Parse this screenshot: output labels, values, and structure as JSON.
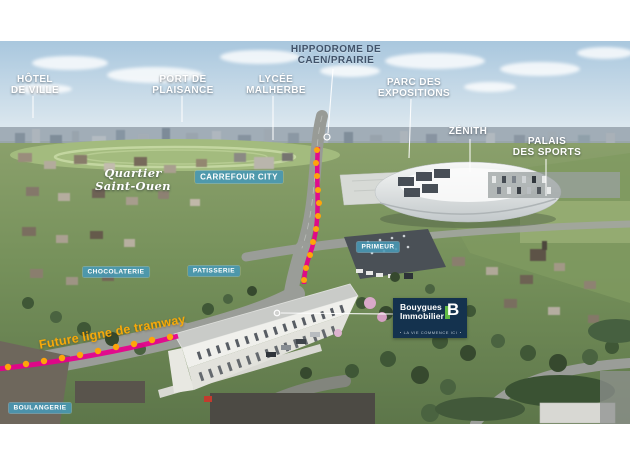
{
  "labels": {
    "hotel_de_ville": {
      "line1": "HÔTEL",
      "line2": "DE VILLE"
    },
    "port_de_plaisance": {
      "line1": "PORT DE",
      "line2": "PLAISANCE"
    },
    "lycee_malherbe": {
      "line1": "LYCÉE",
      "line2": "MALHERBE"
    },
    "hippodrome": {
      "line1": "HIPPODROME DE",
      "line2": "CAEN/PRAIRIE"
    },
    "parc_des_expositions": {
      "line1": "PARC DES",
      "line2": "EXPOSITIONS"
    },
    "zenith": {
      "line1": "ZÉNITH"
    },
    "palais_des_sports": {
      "line1": "PALAIS",
      "line2": "DES SPORTS"
    },
    "quartier_saint_ouen": {
      "line1": "Quartier",
      "line2": "Saint-Ouen"
    }
  },
  "badges": {
    "carrefour_city": "CARREFOUR CITY",
    "primeur": "PRIMEUR",
    "chocolaterie": "CHOCOLATERIE",
    "patisserie": "PATISSERIE",
    "boulangerie": "BOULANGERIE"
  },
  "tramway": {
    "label": "Future ligne de tramway",
    "line_color": "#e6008c",
    "dot_color": "#ffa40a"
  },
  "logo": {
    "brand_line1": "Bouygues",
    "brand_line2": "Immobilier",
    "letter": "B",
    "tagline": "LA VIE COMMENCE ICI",
    "bg_color": "#14324e",
    "accent_green": "#62bb46"
  },
  "colors": {
    "badge_teal": "#4899b6",
    "label_white": "#ffffff",
    "hippodrome_slate": "#41536a",
    "tram_magenta": "#e6008c",
    "tram_dot_orange": "#ffa40a"
  }
}
